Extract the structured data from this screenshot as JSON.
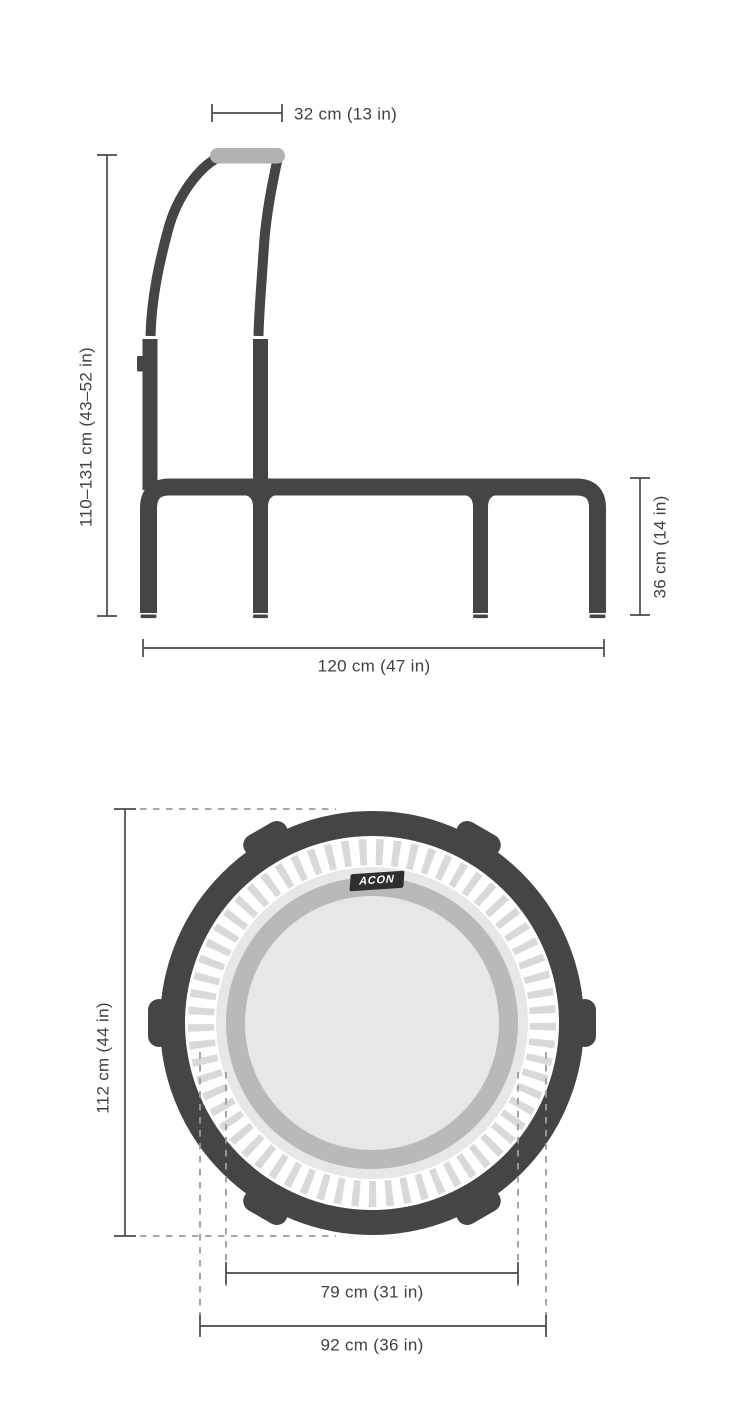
{
  "side_view": {
    "name": "trampoline side view with handlebar",
    "labels": {
      "handlebar_width": "32 cm (13 in)",
      "handlebar_height": "110–131 cm (43–52 in)",
      "frame_height": "36 cm (14 in)",
      "frame_width": "120 cm (47 in)"
    }
  },
  "top_view": {
    "name": "trampoline top view",
    "brand": "ACON",
    "labels": {
      "outer_diameter": "112 cm (44 in)",
      "mat_diameter": "79 cm (31 in)",
      "pad_diameter": "92 cm (36 in)"
    }
  },
  "colors": {
    "tube": "#454545",
    "grip": "#b2b2b2",
    "dim": "#4a4a4a",
    "dash": "#9b9b9b",
    "tick": "#d9d9d9",
    "padring": "#b9b9b9",
    "mat": "#e7e7e7",
    "badgebg": "#2f2f2f",
    "badgetext": "#ffffff",
    "label": "#414141"
  }
}
